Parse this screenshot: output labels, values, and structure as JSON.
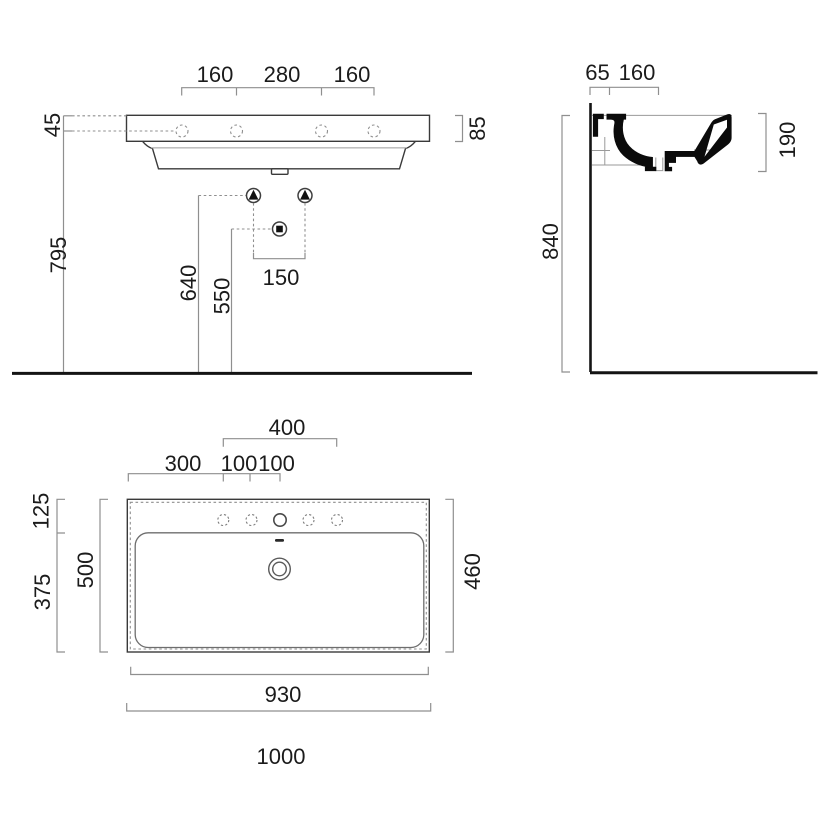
{
  "drawing": {
    "front_view": {
      "dim_tap_left": "160",
      "dim_tap_center": "280",
      "dim_tap_right": "160",
      "dim_rim_top": "45",
      "dim_rim_height": "85",
      "dim_floor_to_rim": "795",
      "dim_floor_to_fixing": "640",
      "dim_floor_to_drain": "550",
      "dim_fixing_spacing": "150"
    },
    "side_view": {
      "dim_wall_offset": "65",
      "dim_deck_depth": "160",
      "dim_front_height": "190",
      "dim_total_height": "840"
    },
    "plan_view": {
      "dim_tap_span": "400",
      "dim_left_to_tap": "300",
      "dim_tap_gap_1": "100",
      "dim_tap_gap_2": "100",
      "dim_back_ledge": "125",
      "dim_bowl_depth": "500",
      "dim_front_depth": "375",
      "dim_inner_depth": "460",
      "dim_inner_width": "930",
      "dim_total_width": "1000"
    },
    "colors": {
      "outline": "#3a3a3a",
      "section_fill": "#0b0b0b",
      "dimension_line": "#8f8f8f",
      "text": "#1b1b1b",
      "floor_line": "#141414",
      "background": "#ffffff"
    }
  }
}
